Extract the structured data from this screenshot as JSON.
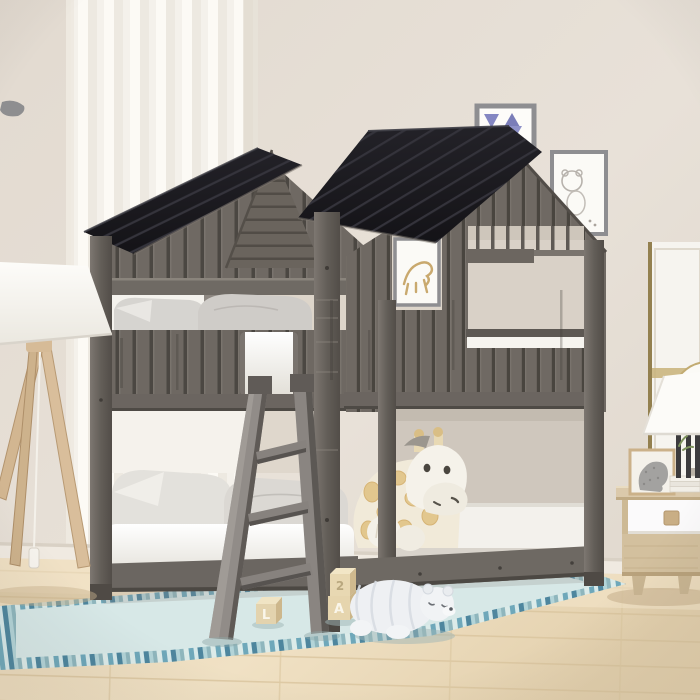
{
  "scene": {
    "description": "Product lifestyle photo: a full-over-full bunk bed built as a rustic weathered-gray wood playhouse with two black gabled roofs, window cut-outs, and an angled ladder. White mattresses and gray pillows on both bunks, a plush giraffe on the lower bed, a striped plush polar bear and alphabet blocks on a pale aqua fringed rug, a wooden tripod floor lamp at left, and a light-wood nightstand with a white drawer, decor cube, books and a white lamp at right. Beige wall with framed prints and a sheer white curtain.",
    "palette": {
      "wall": "#e6dfd6",
      "wall_shadow": "#d9d1c5",
      "curtain": "#f7f4ef",
      "baseboard": "#f0eae1",
      "floor_wood": "#ecdcbd",
      "bed_wood": "#6f6963",
      "bed_wood_dark": "#57524d",
      "roof_black": "#1b1a1e",
      "mattress_white": "#f6f4ef",
      "pillow_gray": "#d3d1cd",
      "accent_pillow_yellow": "#e5c23c",
      "rug_aqua": "#dcecea",
      "rug_stripe_teal": "#6fa8ba",
      "rug_stripe_blue": "#4e869e",
      "ladder_gray": "#8f8a85",
      "nightstand_wood": "#d3c09e",
      "drawer_white": "#fbfafb",
      "lamp_leg_wood": "#d9be9b",
      "art_gold": "#c8b179",
      "pennant_purple": "#8487c2",
      "giraffe_spot": "#e2c78e",
      "polar_bear_white": "#eef0f3"
    },
    "toys": {
      "blocks": [
        {
          "letter": "L"
        },
        {
          "letter": "2"
        },
        {
          "letter": "A"
        }
      ]
    }
  }
}
